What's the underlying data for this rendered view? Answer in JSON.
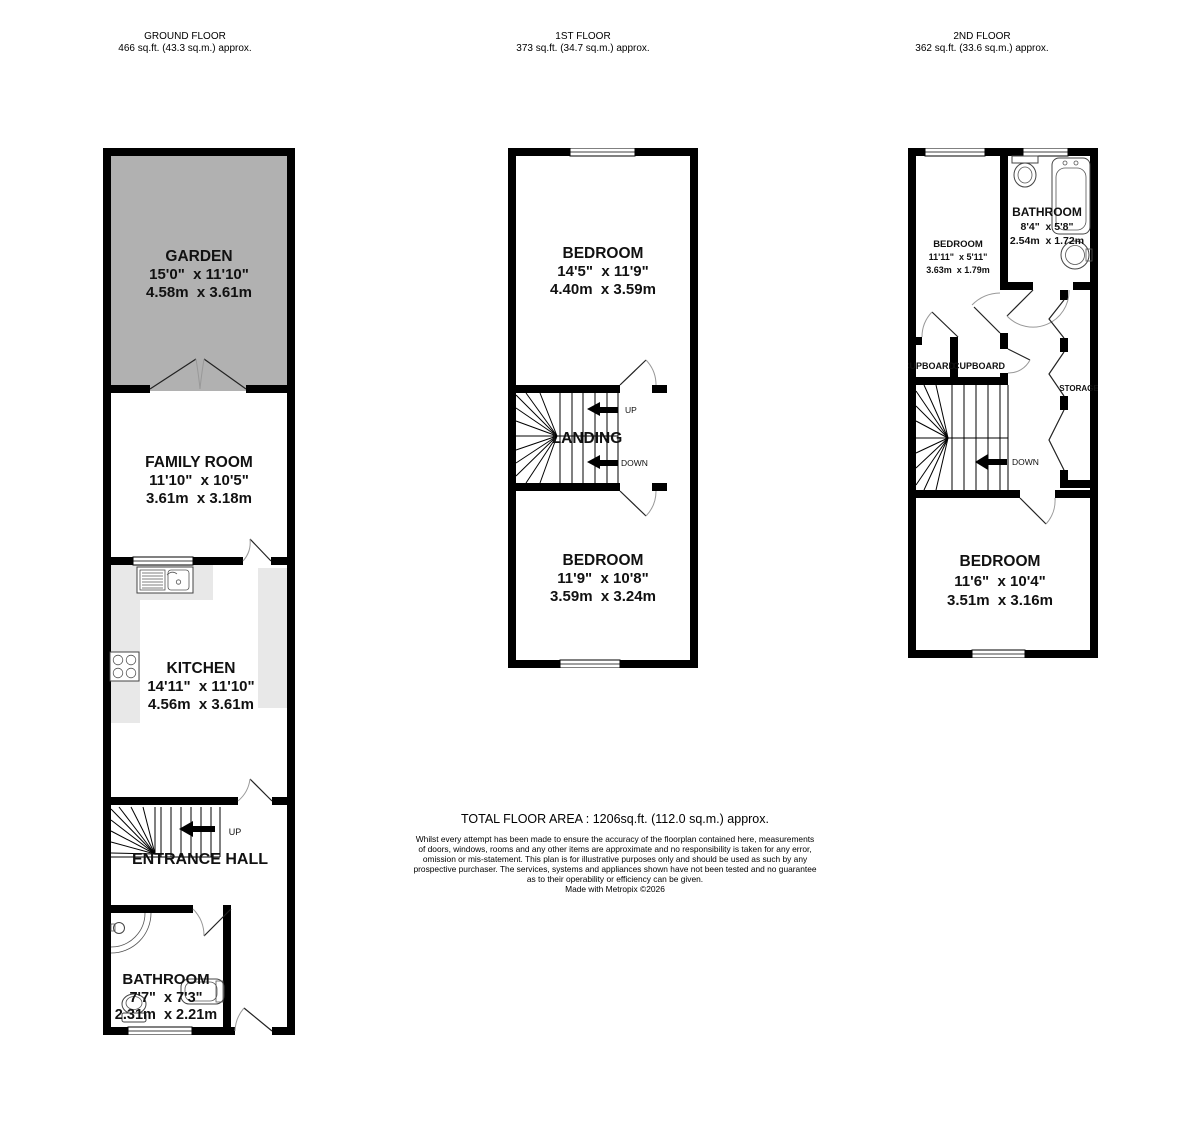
{
  "headers": [
    {
      "title": "GROUND FLOOR",
      "area": "466 sq.ft. (43.3 sq.m.) approx."
    },
    {
      "title": "1ST FLOOR",
      "area": "373 sq.ft. (34.7 sq.m.) approx."
    },
    {
      "title": "2ND FLOOR",
      "area": "362 sq.ft. (33.6 sq.m.) approx."
    }
  ],
  "ground_floor": {
    "garden": {
      "name": "GARDEN",
      "imperial": "15'0\"  x 11'10\"",
      "metric": "4.58m  x 3.61m"
    },
    "family_room": {
      "name": "FAMILY ROOM",
      "imperial": "11'10\"  x 10'5\"",
      "metric": "3.61m  x 3.18m"
    },
    "kitchen": {
      "name": "KITCHEN",
      "imperial": "14'11\"  x 11'10\"",
      "metric": "4.56m  x 3.61m"
    },
    "entrance_hall": {
      "name": "ENTRANCE HALL"
    },
    "bathroom": {
      "name": "BATHROOM",
      "imperial": "7'7\"  x 7'3\"",
      "metric": "2.31m  x 2.21m"
    },
    "up_label": "UP"
  },
  "first_floor": {
    "bedroom_front": {
      "name": "BEDROOM",
      "imperial": "14'5\"  x 11'9\"",
      "metric": "4.40m  x 3.59m"
    },
    "landing": {
      "name": "LANDING"
    },
    "bedroom_back": {
      "name": "BEDROOM",
      "imperial": "11'9\"  x 10'8\"",
      "metric": "3.59m  x 3.24m"
    },
    "up_label": "UP",
    "down_label": "DOWN"
  },
  "second_floor": {
    "bedroom_front": {
      "name": "BEDROOM",
      "imperial": "11'11\"  x 5'11\"",
      "metric": "3.63m  x 1.79m"
    },
    "bathroom": {
      "name": "BATHROOM",
      "imperial": "8'4\"  x 5'8\"",
      "metric": "2.54m  x 1.72m"
    },
    "cupboard_left": "CUPBOARD",
    "cupboard_right": "CUPBOARD",
    "storage": "STORAGE",
    "bedroom_back": {
      "name": "BEDROOM",
      "imperial": "11'6\"  x 10'4\"",
      "metric": "3.51m  x 3.16m"
    },
    "down_label": "DOWN"
  },
  "footer": {
    "total": "TOTAL FLOOR AREA : 1206sq.ft. (112.0 sq.m.) approx.",
    "disclaimer_lines": [
      "Whilst every attempt has been made to ensure the accuracy of the floorplan contained here, measurements",
      "of doors, windows, rooms and any other items are approximate and no responsibility is taken for any error,",
      "omission or mis-statement. This plan is for illustrative purposes only and should be used as such by any",
      "prospective purchaser. The services, systems and appliances shown have not been tested and no guarantee",
      "as to their operability or efficiency can be given.",
      "Made with Metropix ©2026"
    ]
  },
  "colors": {
    "wall": "#000000",
    "garden": "#b1b1b1",
    "counter": "#e8e8e8"
  }
}
